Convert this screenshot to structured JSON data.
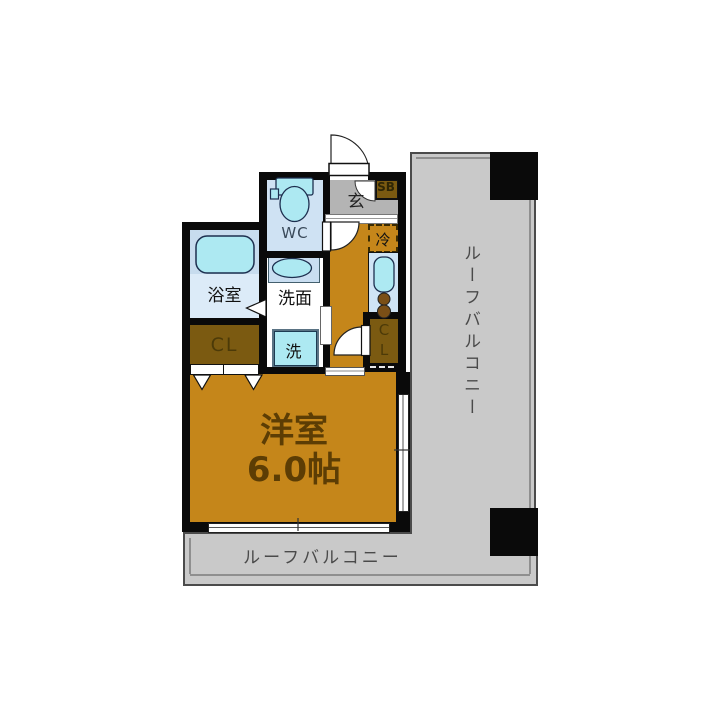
{
  "plan": {
    "rooms": {
      "main_room": {
        "name": "洋室",
        "size": "6.0帖"
      },
      "bathroom": {
        "label": "浴室"
      },
      "washroom": {
        "label": "洗面"
      },
      "washer": {
        "label": "洗"
      },
      "wc": {
        "label": "WC"
      },
      "entrance": {
        "label": "玄"
      },
      "shoebox": {
        "label": "SB"
      },
      "refrigerator": {
        "label": "冷"
      },
      "closet_left": {
        "label": "CL"
      },
      "closet_right": {
        "line1": "C",
        "line2": "L"
      },
      "balcony_right": {
        "label": "ルーフバルコニー"
      },
      "balcony_bottom": {
        "label": "ルーフバルコニー"
      }
    },
    "colors": {
      "wall_black": "#0a0a0a",
      "floor_orange": "#c5861a",
      "closet_brown": "#7b5a11",
      "fixture_cyan": "#ade9f2",
      "room_lightblue": "#cfe2f3",
      "entrance_gray": "#b4b4b4",
      "balcony_gray": "#c9c9c9"
    }
  }
}
